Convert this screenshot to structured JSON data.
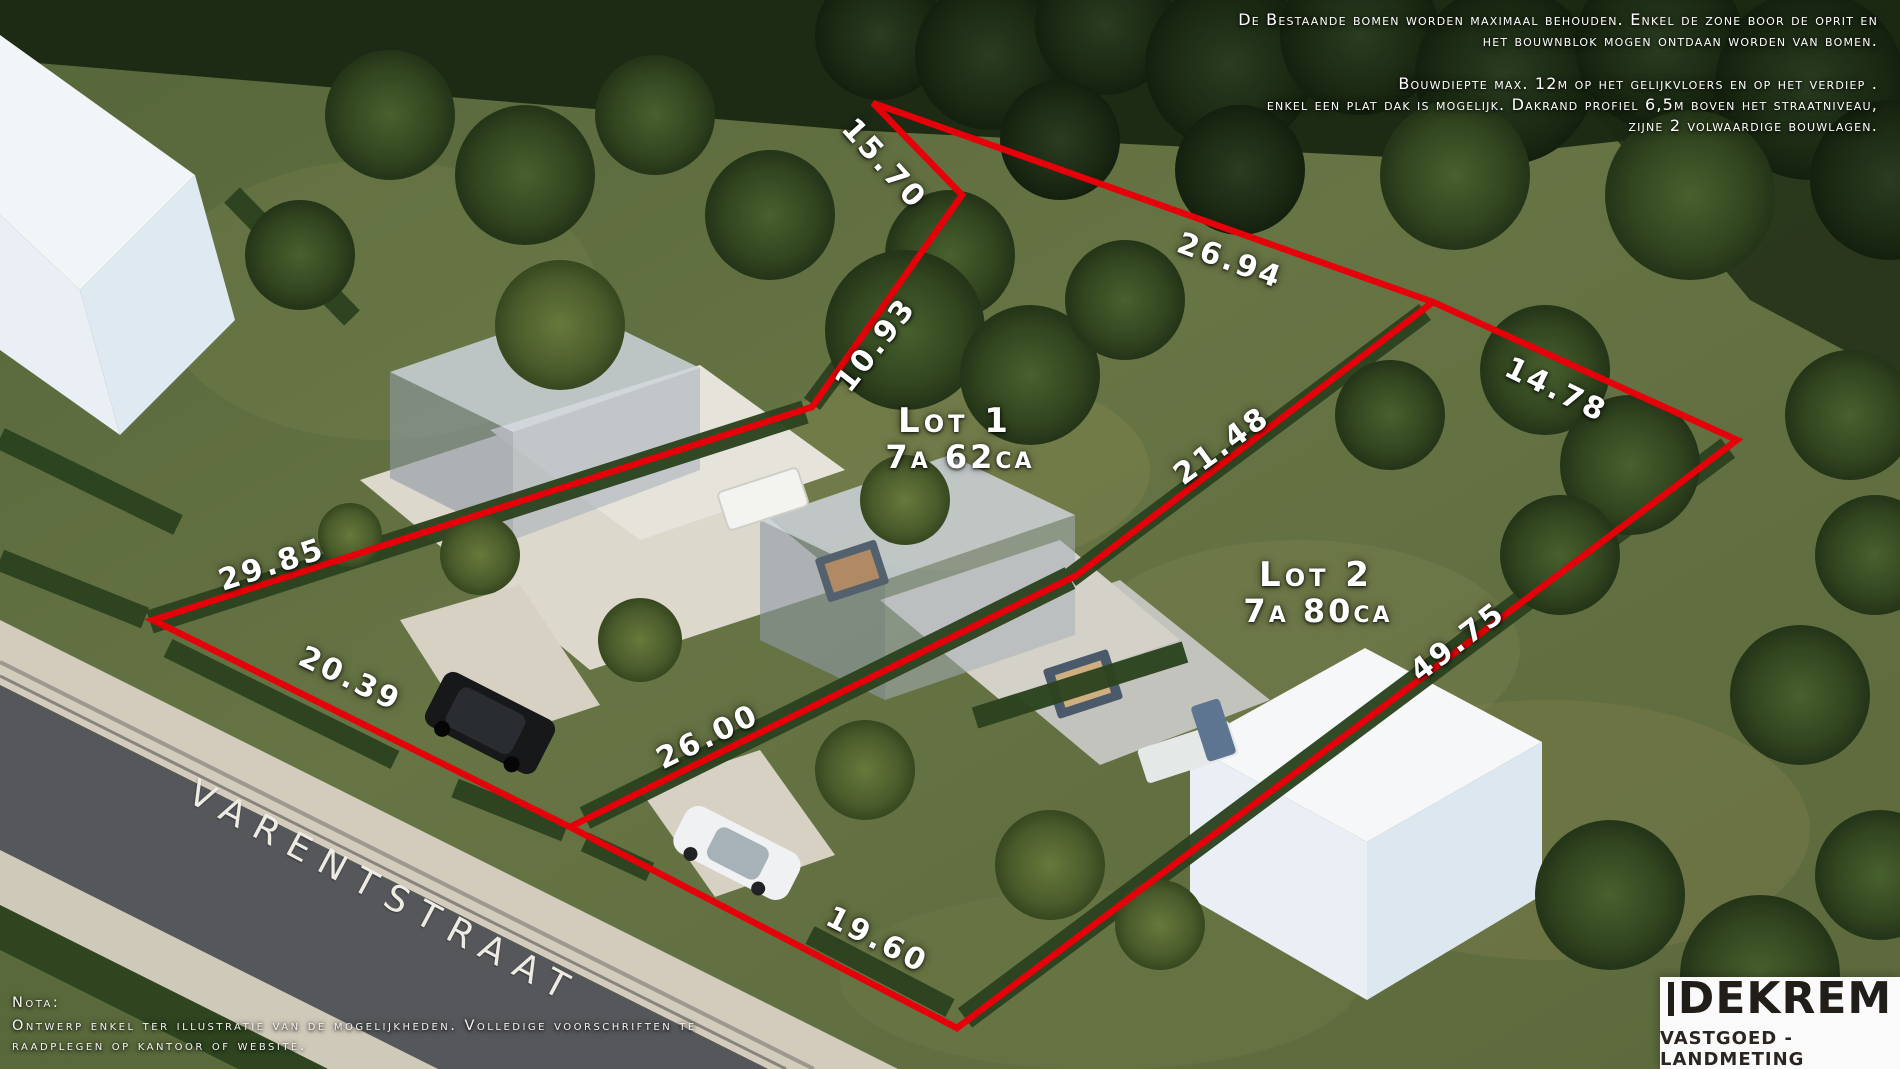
{
  "annotations": {
    "top_right_para1": [
      "De Bestaande bomen worden maximaal behouden. Enkel de zone boor de oprit en",
      "het bouwnblok mogen ontdaan worden van bomen."
    ],
    "top_right_para2": [
      "Bouwdiepte max. 12m op het gelijkvloers en op het verdiep .",
      "enkel een plat dak is mogelijk. Dakrand profiel 6,5m boven het straatniveau,",
      "zijne 2 volwaardige bouwlagen."
    ],
    "nota_title": "Nota:",
    "nota_lines": [
      "Ontwerp enkel ter illustratie van de mogelijkheden. Volledige voorschriften te",
      "raadplegen op kantoor of website."
    ]
  },
  "measurements": [
    {
      "label": "15.70"
    },
    {
      "label": "10.93"
    },
    {
      "label": "26.94"
    },
    {
      "label": "14.78"
    },
    {
      "label": "21.48"
    },
    {
      "label": "29.85"
    },
    {
      "label": "20.39"
    },
    {
      "label": "26.00"
    },
    {
      "label": "19.60"
    },
    {
      "label": "49.75"
    }
  ],
  "lots": [
    {
      "name": "Lot 1",
      "area": "7a 62ca"
    },
    {
      "name": "Lot 2",
      "area": "7a 80ca"
    }
  ],
  "street_name": "VARENTSTRAAT",
  "logo": {
    "brand": "DEKREM",
    "tagline": "VASTGOED - LANDMETING"
  },
  "colors": {
    "boundary_red": "#e60009",
    "label_text": "#ffffff",
    "logo_rule": "#6d3326"
  }
}
